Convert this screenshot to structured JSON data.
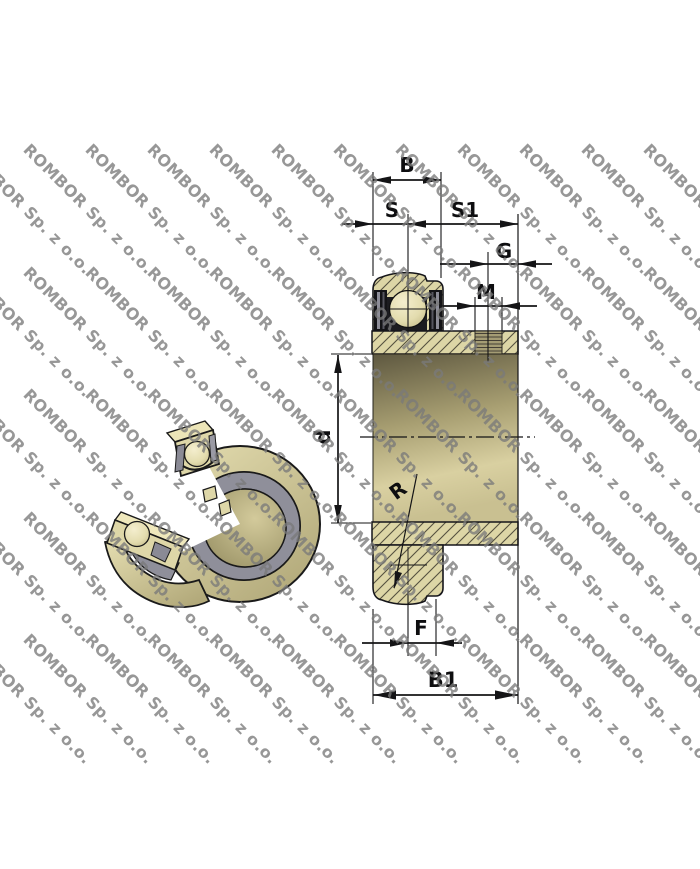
{
  "watermark": {
    "text": "ROMBOR Sp. z o.o."
  },
  "drawing": {
    "labels": {
      "b": "B",
      "s": "S",
      "s1": "S1",
      "g": "G",
      "m": "M",
      "d": "d",
      "r": "R",
      "f": "F",
      "b1": "B1"
    },
    "colors": {
      "hatch_fill": "#ddd6a6",
      "hatch_line": "#55513f",
      "shaft_dark": "#5e5840",
      "shaft_light": "#d9d0a1",
      "seal_gray": "#8f8f9a",
      "line_black": "#141416",
      "ball_light": "#f2ecc8"
    }
  }
}
